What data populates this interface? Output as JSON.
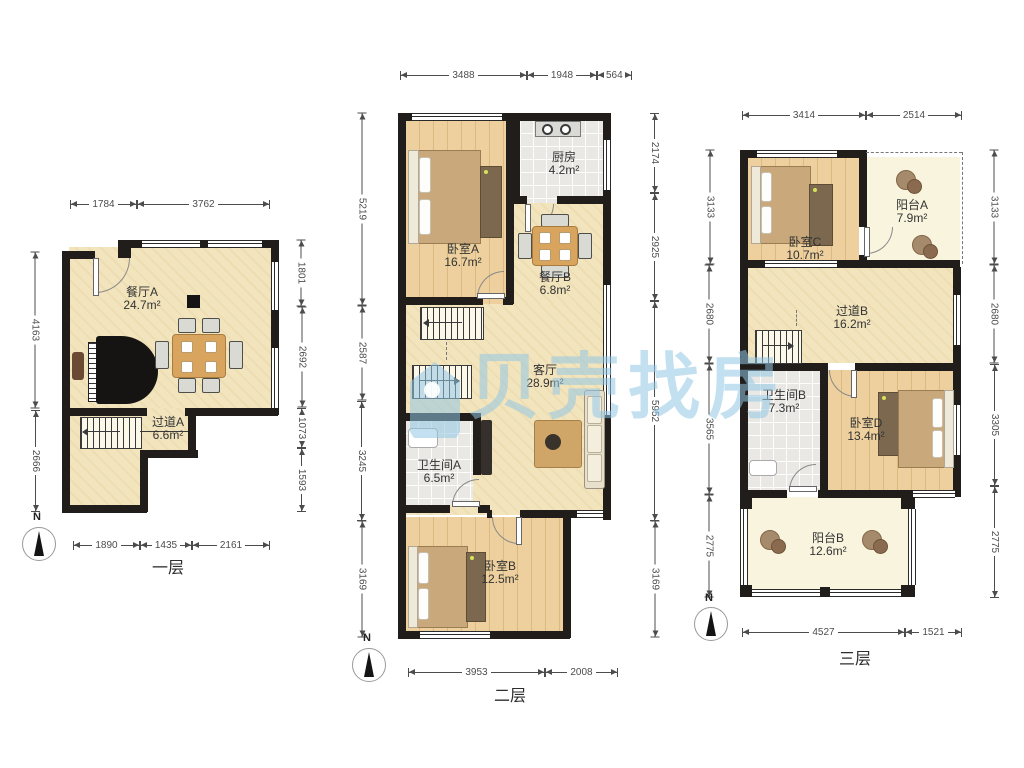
{
  "watermark": {
    "text": "贝壳找房"
  },
  "north_label": "N",
  "colors": {
    "wall": "#201d1a",
    "floor_cream": "#f2e4bd",
    "floor_wood": "#edd09d",
    "floor_tile": "#e9e8e4",
    "floor_balcony": "#f8f4de",
    "watermark_blue": "#92c6e6",
    "dim_text": "#4c4c4c"
  },
  "floors": [
    {
      "label": "一层",
      "rooms": {
        "dining_a": {
          "name": "餐厅A",
          "area": "24.7m²"
        },
        "hall_a": {
          "name": "过道A",
          "area": "6.6m²"
        }
      },
      "dims_top": [
        "1784",
        "3762"
      ],
      "dims_bottom": [
        "1890",
        "1435",
        "2161"
      ],
      "dims_left": [
        "4163",
        "2666"
      ],
      "dims_right": [
        "1801",
        "2692",
        "1073",
        "1593"
      ]
    },
    {
      "label": "二层",
      "rooms": {
        "bedroom_a": {
          "name": "卧室A",
          "area": "16.7m²"
        },
        "kitchen": {
          "name": "厨房",
          "area": "4.2m²"
        },
        "dining_b": {
          "name": "餐厅B",
          "area": "6.8m²"
        },
        "living": {
          "name": "客厅",
          "area": "28.9m²"
        },
        "bath_a": {
          "name": "卫生间A",
          "area": "6.5m²"
        },
        "bedroom_b": {
          "name": "卧室B",
          "area": "12.5m²"
        }
      },
      "dims_top": [
        "3488",
        "1948",
        "564"
      ],
      "dims_bottom": [
        "3953",
        "2008"
      ],
      "dims_left": [
        "5219",
        "2587",
        "3245",
        "3169"
      ],
      "dims_right": [
        "2174",
        "2925",
        "5952",
        "3169"
      ]
    },
    {
      "label": "三层",
      "rooms": {
        "bedroom_c": {
          "name": "卧室C",
          "area": "10.7m²"
        },
        "balcony_a": {
          "name": "阳台A",
          "area": "7.9m²"
        },
        "hall_b": {
          "name": "过道B",
          "area": "16.2m²"
        },
        "bath_b": {
          "name": "卫生间B",
          "area": "7.3m²"
        },
        "bedroom_d": {
          "name": "卧室D",
          "area": "13.4m²"
        },
        "balcony_b": {
          "name": "阳台B",
          "area": "12.6m²"
        }
      },
      "dims_top": [
        "3414",
        "2514"
      ],
      "dims_bottom": [
        "4527",
        "1521"
      ],
      "dims_left": [
        "3133",
        "2680",
        "3565",
        "2775"
      ],
      "dims_right": [
        "3133",
        "2680",
        "3305",
        "2775"
      ]
    }
  ]
}
